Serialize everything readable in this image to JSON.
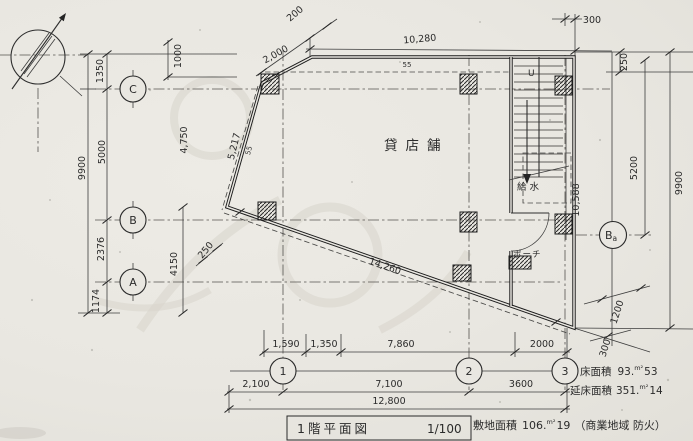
{
  "drawing": {
    "title": "1階平面図",
    "scale": "1/100",
    "room_labels": {
      "shop": "貸店舗",
      "water": "給水",
      "porch": "ポーチ",
      "stair_up": "U"
    },
    "areas": {
      "floor": {
        "label": "床面積",
        "int": "93.",
        "unit": "m²",
        "dec": "53"
      },
      "total_floor": {
        "label": "延床面積",
        "int": "351.",
        "unit": "m²",
        "dec": "14"
      },
      "site": {
        "label": "敷地面積",
        "int": "106.",
        "unit": "m²",
        "dec": "19",
        "note": "（商業地域 防火）"
      }
    },
    "grid": {
      "c": "C",
      "b": "B",
      "a": "A",
      "ba_main": "B",
      "ba_sub": "a",
      "n1": "1",
      "n2": "2",
      "n3": "3"
    },
    "dims": {
      "top_200": "200",
      "top_2000": "2,000",
      "top_10280": "10,280",
      "top_300": "300",
      "top_250": "250",
      "left_1000": "1000",
      "left_1350": "1350",
      "left_5000": "5000",
      "left_9900": "9900",
      "left_4750": "4,750",
      "left_2376": "2376",
      "left_1174": "1174",
      "wall_5217": "5,217",
      "wall_55": "55",
      "inner_55": "55",
      "corner_250": "250",
      "left_4150": "4150",
      "diag_14260": "14,260",
      "right_10588": "10,588",
      "right_5200": "5200",
      "right_9900": "9900",
      "corner_1200": "1200",
      "corner_300": "300",
      "row1_1590": "1,590",
      "row1_1350": "1,350",
      "row1_7860": "7,860",
      "row1_2000": "2000",
      "row2_2100": "2,100",
      "row2_7100": "7,100",
      "row2_3600": "3600",
      "row3_12800": "12,800"
    }
  }
}
